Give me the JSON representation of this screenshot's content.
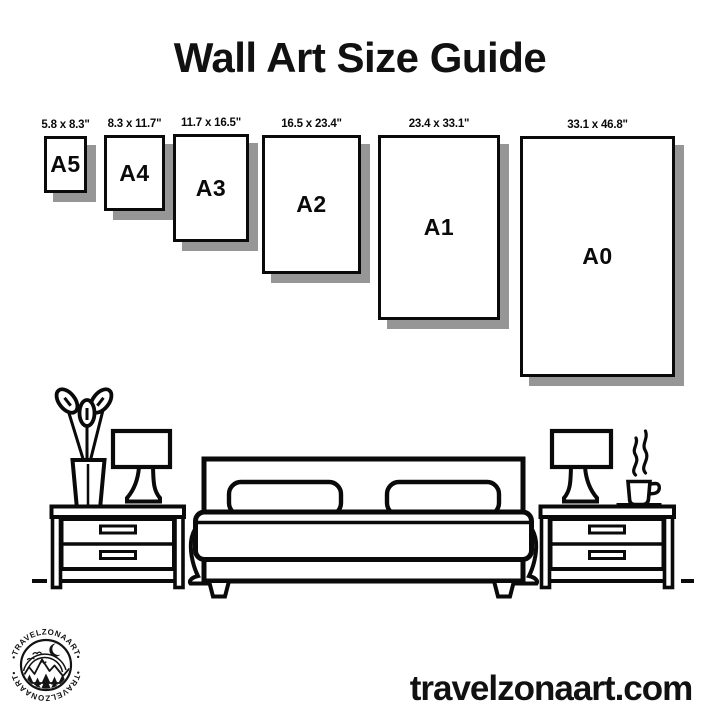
{
  "title": "Wall Art Size Guide",
  "sizes": [
    {
      "label": "A5",
      "dimensions": "5.8 x 8.3\""
    },
    {
      "label": "A4",
      "dimensions": "8.3 x 11.7\""
    },
    {
      "label": "A3",
      "dimensions": "11.7 x 16.5\""
    },
    {
      "label": "A2",
      "dimensions": "16.5 x 23.4\""
    },
    {
      "label": "A1",
      "dimensions": "23.4 x 33.1\""
    },
    {
      "label": "A0",
      "dimensions": "33.1 x 46.8\""
    }
  ],
  "footer": {
    "website": "travelzonaart.com"
  },
  "logo": {
    "brand_arc": "•TRAVELZONAART•"
  },
  "icons": [
    "flower-vase-icon",
    "table-lamp-icon",
    "nightstand-icon",
    "bed-icon",
    "pillow-icon",
    "coffee-cup-icon",
    "steam-icon",
    "mountain-badge-logo"
  ],
  "colors": {
    "ink": "#0a0a0a",
    "background": "#ffffff",
    "frame_shadow": "#969696"
  }
}
